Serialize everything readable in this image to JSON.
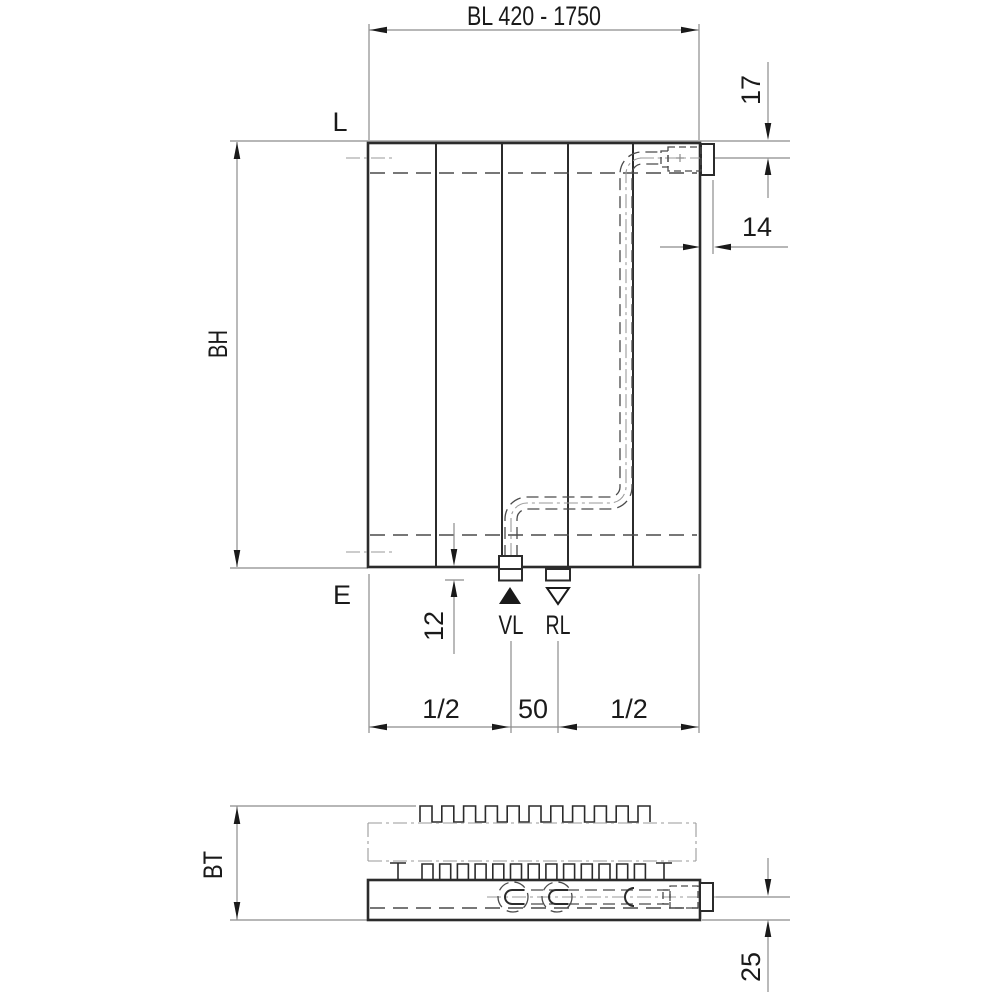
{
  "front_view": {
    "width_dim": "BL 420 - 1750",
    "height_dim": "BH",
    "top_level_label": "L",
    "bottom_level_label": "E",
    "top_connection_offset_dim": "17",
    "side_connection_offset_dim": "14",
    "stub_height_dim": "12",
    "supply_label": "VL",
    "return_label": "RL",
    "bottom_dims": {
      "left": "1/2",
      "center": "50",
      "right": "1/2"
    }
  },
  "section_view": {
    "depth_dim": "BT",
    "bottom_connection_offset_dim": "25"
  },
  "symbols": {
    "supply_icon": "filled-triangle-up",
    "return_icon": "open-triangle-down"
  },
  "colors": {
    "background": "#ffffff",
    "object_line": "#2b2b2b",
    "thin_line": "#8c8c8c",
    "hidden_line": "#4a4a4a",
    "center_line": "#9a9a9a",
    "text": "#1a1a1a"
  }
}
